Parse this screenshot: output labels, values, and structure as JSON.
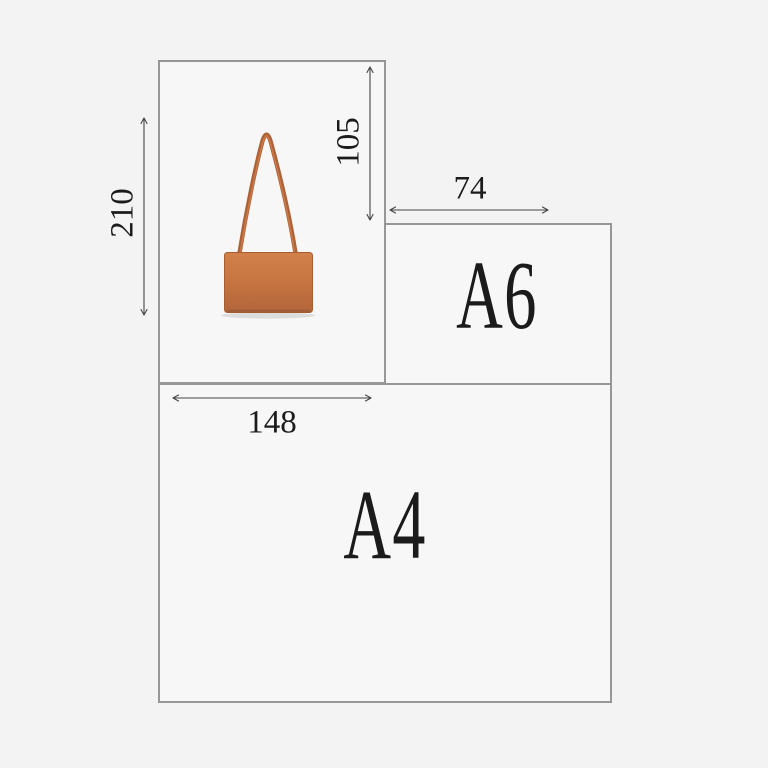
{
  "diagram": {
    "kind": "product-size-comparison",
    "background_color": "#f3f3f4",
    "panel_fill": "#f7f7f7",
    "panel_border_color": "#979797",
    "arrow_color": "#454545",
    "text_color": "#1b1b1b"
  },
  "papers": {
    "a4": {
      "label": "A4"
    },
    "a6": {
      "label": "A6"
    }
  },
  "measurements": {
    "left_vertical": {
      "value": "210",
      "orientation": "vertical"
    },
    "inner_vertical": {
      "value": "105",
      "orientation": "vertical"
    },
    "a6_horizontal": {
      "value": "74",
      "orientation": "horizontal"
    },
    "a4_horizontal": {
      "value": "148",
      "orientation": "horizontal"
    }
  },
  "product": {
    "icon": "shoulder-bag-image",
    "body_color_top": "#d3814b",
    "body_color_mid": "#c67440",
    "body_color_bottom": "#b2663c",
    "strap_color": "#ad6136",
    "strap_highlight": "#cf7f4b",
    "body_edge_color": "#a85e34"
  }
}
